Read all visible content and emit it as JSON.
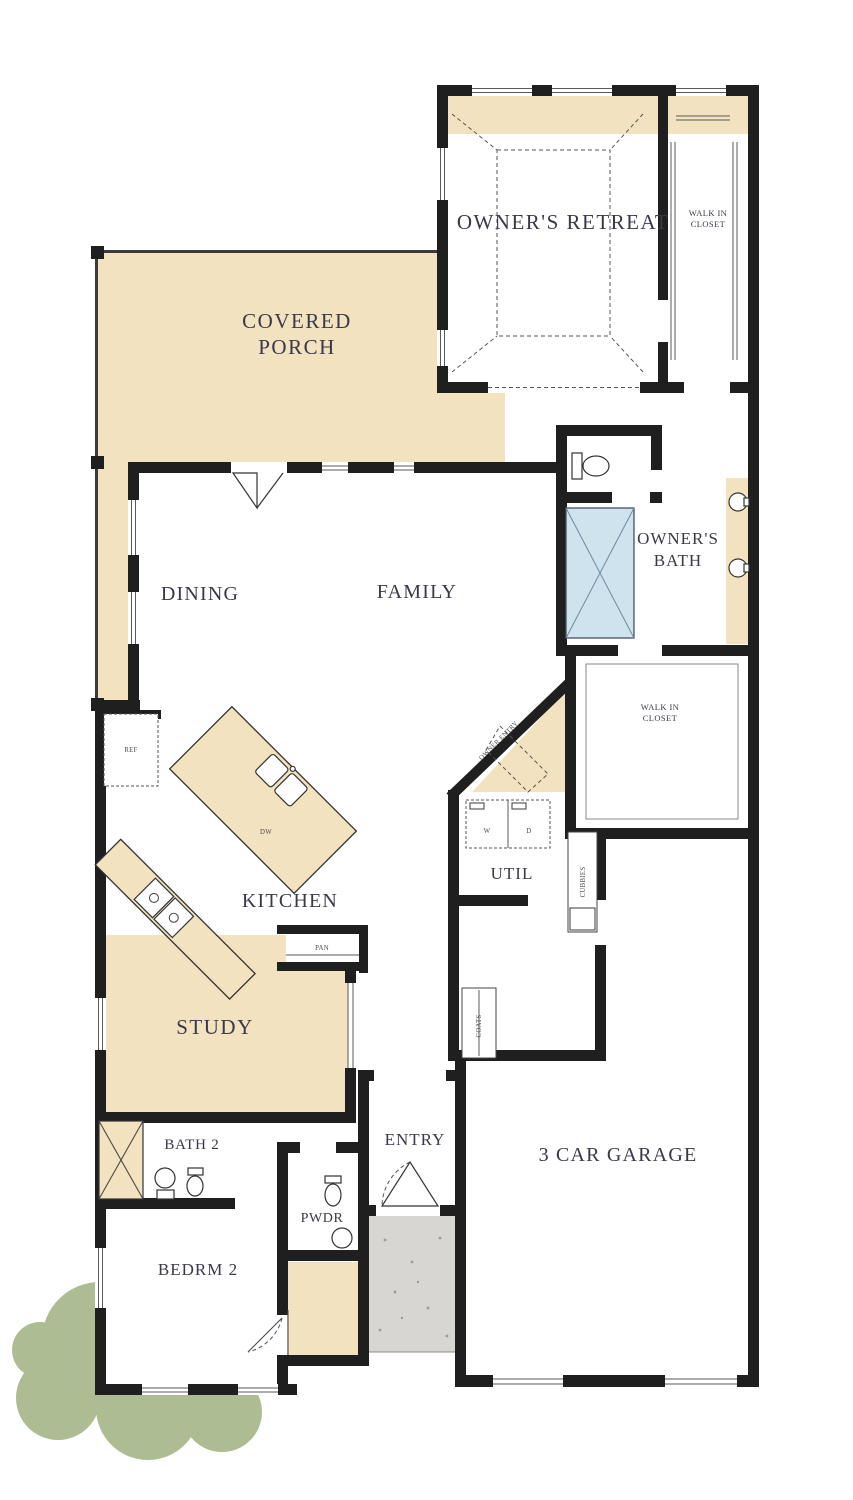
{
  "plan": {
    "rooms": {
      "owners_retreat": "OWNER'S RETREAT",
      "walk_in_closet_owner": {
        "line1": "WALK IN",
        "line2": "CLOSET"
      },
      "covered_porch": {
        "line1": "COVERED",
        "line2": "PORCH"
      },
      "dining": "DINING",
      "family": "FAMILY",
      "owners_bath": {
        "line1": "OWNER'S",
        "line2": "BATH"
      },
      "walk_in_closet_mid": {
        "line1": "WALK IN",
        "line2": "CLOSET"
      },
      "kitchen": "KITCHEN",
      "util": "UTIL",
      "study": "STUDY",
      "bath_2": "BATH 2",
      "entry": "ENTRY",
      "garage": "3 CAR GARAGE",
      "pwdr": "PWDR",
      "bedrm_2": "BEDRM 2"
    },
    "fixtures": {
      "ref": "REF",
      "dw": "DW",
      "pan": "PAN",
      "washer": "W",
      "dryer": "D",
      "coats": "COATS",
      "cubbies": "CUBBIES",
      "owner_entry": "OWNER ENTRY"
    },
    "colors": {
      "wall": "#1f1f1f",
      "floor": "#ffffff",
      "porch_tan": "#f3e2bf",
      "shower_blue": "#cfe3ee",
      "bush_green": "#a9b98e",
      "stoop_gray": "#d8d6d2",
      "label_ink": "#39394a",
      "dw_blue": "#4a6f8f"
    }
  }
}
